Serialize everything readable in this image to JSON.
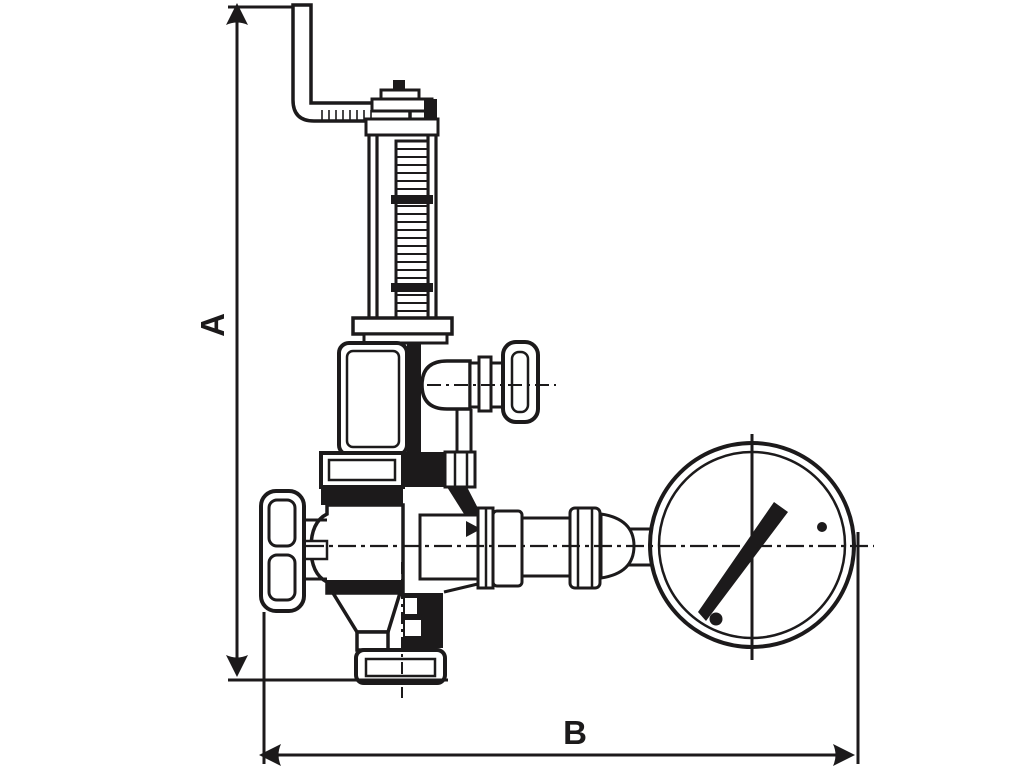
{
  "diagram": {
    "type": "technical-line-drawing",
    "subject": "spring-loaded safety relief valve with test lever, handwheel and pressure gauge, overall dimension drawing",
    "dimension_labels": {
      "height": "A",
      "width": "B"
    },
    "colors": {
      "line": "#1c1a1b",
      "background": "#ffffff"
    }
  }
}
